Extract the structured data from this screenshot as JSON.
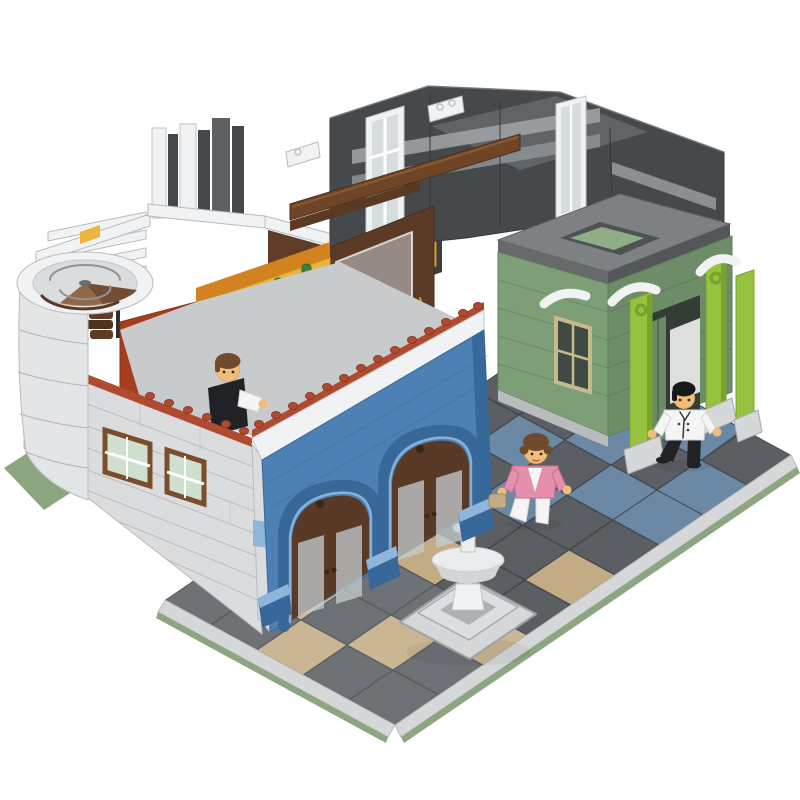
{
  "image": {
    "type": "product-photo",
    "alt": "LEGO-style modular street-corner building MOC: white rounded corner building with spiral staircase and rooftop terrace, blue double-arch arcade facade, dark gray upper walls, sand-green arcade shop with lime pillars, tiled plaza with white fountain and three minifigures on a white background",
    "background": "#ffffff"
  },
  "palette": {
    "bg": "#ffffff",
    "wall": "#dadcde",
    "wall_line": "#b2b5b8",
    "white": "#f1f2f3",
    "blue": "#4d80b4",
    "blue_dk": "#38679a",
    "blue_lt": "#8fb6da",
    "stud": "#b04a30",
    "rust": "#a63d1f",
    "orange": "#d2821f",
    "yellow": "#e8b73c",
    "sand": "#7e9e78",
    "sand_dk": "#6d8d68",
    "lime": "#97c23f",
    "lime_dk": "#79a42b",
    "anth": "#46494b",
    "anth_lt": "#5d6163",
    "stripe": "#9da1a4",
    "roof": "#7d8183",
    "cornice": "#54575a",
    "tile": "#5b5f63",
    "tile_ln": "#46494d",
    "tan": "#c3ac84",
    "steel": "#6b88a5",
    "curb": "#d5d7d9",
    "plate": "#8ba681",
    "door": "#583a26",
    "beam": "#6e4527",
    "glass": "#c4ced1",
    "glassdk": "#3f4a42",
    "skin": "#f1bd79",
    "pink": "#e48fab",
    "cloth": "#f5f5f5",
    "black": "#202225",
    "hair_brown": "#6f4a2b",
    "gray": "#9fa3a6",
    "gray_lt": "#e4e5e6",
    "gold": "#c8a23c"
  },
  "scene": {
    "ground": {
      "baseplate_color_name": "sage-green",
      "plaza": "dark gray 2x2 tiles",
      "accents_left": "tan checker tiles near fountain",
      "accents_right": "steel-blue tile patches near green building",
      "curb": "light gray curb along two front edges"
    },
    "buildings": [
      {
        "name": "corner-building",
        "walls": "light gray with rounded corner and spiral staircase",
        "facade": "blue double arch arcade with dark brown glass doors",
        "parapet": "white with dark-orange studded row",
        "terrace": "yellow, orange and rust interior walls, white arch trims, cacti, statues"
      },
      {
        "name": "rear-building",
        "walls": "anthracite gray with light gray bands and tall white window frames, open top, brown timber beam"
      },
      {
        "name": "green-arcade-building",
        "walls": "sand green",
        "pillars": "lime green with white scroll ornaments",
        "roof": "gray with open skylight",
        "window": "tan frame"
      }
    ],
    "fountain": {
      "material": "white with light gray octagonal step base",
      "top": "ball finial"
    },
    "minifigures": [
      {
        "id": "terrace-figure",
        "hair": "brown",
        "torso": "black vest with white sleeve",
        "location": "rooftop terrace behind parapet"
      },
      {
        "id": "woman-figure",
        "hair": "curly brown",
        "torso": "pink jacket over white top",
        "legs": "white",
        "accessory": "tan purse",
        "location": "plaza near fountain"
      },
      {
        "id": "man-figure",
        "hair": "black",
        "torso": "white buttoned jacket",
        "legs": "black",
        "location": "plaza under green arcade"
      }
    ]
  }
}
